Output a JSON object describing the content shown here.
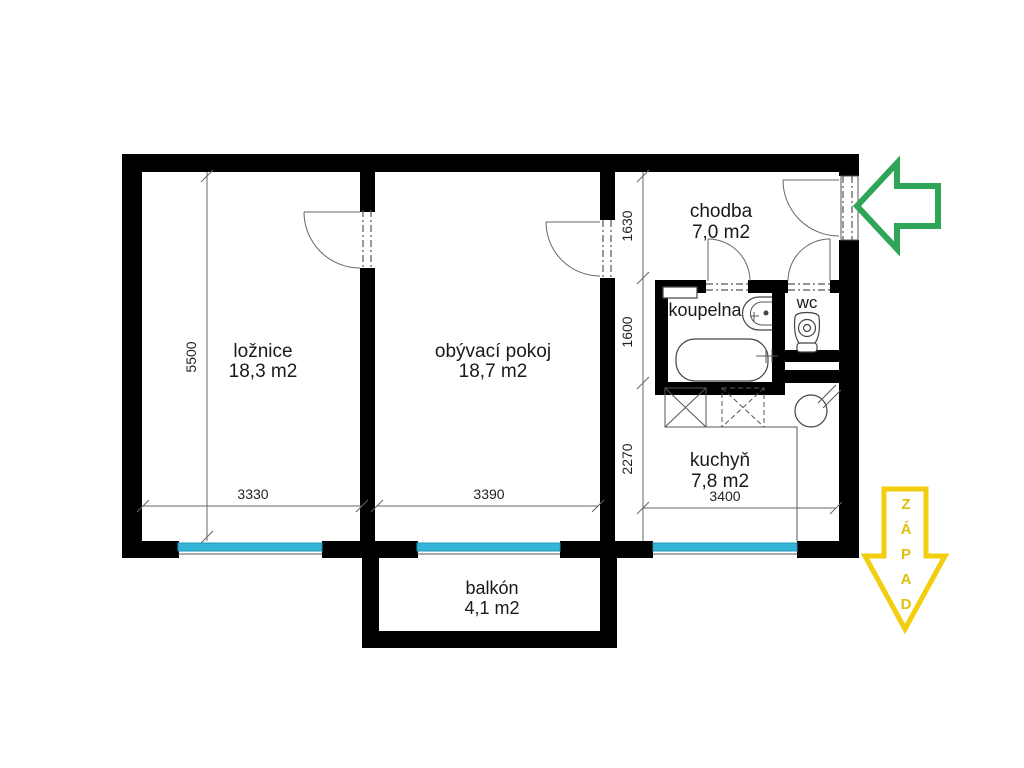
{
  "rooms": {
    "loznice": {
      "name": "ložnice",
      "area": "18,3 m2"
    },
    "obyvaci": {
      "name": "obývací pokoj",
      "area": "18,7 m2"
    },
    "chodba": {
      "name": "chodba",
      "area": "7,0 m2"
    },
    "koupelna": {
      "name": "koupelna"
    },
    "wc": {
      "name": "wc"
    },
    "kuchyn": {
      "name": "kuchyň",
      "area": "7,8 m2"
    },
    "balkon": {
      "name": "balkón",
      "area": "4,1 m2"
    }
  },
  "dimensions": {
    "left_height": "5500",
    "right_top": "1630",
    "right_mid": "1600",
    "right_bottom": "2270",
    "bottom_left": "3330",
    "bottom_mid": "3390",
    "bottom_right": "3400"
  },
  "compass": {
    "west_word": "ZÁPAD",
    "letters": [
      "Z",
      "Á",
      "P",
      "A",
      "D"
    ]
  },
  "colors": {
    "wall": "#000000",
    "window": "#35b5d8",
    "window_border": "#1e98ba",
    "entrance_arrow": "#2fa558",
    "west_arrow": "#f2ce0f"
  }
}
